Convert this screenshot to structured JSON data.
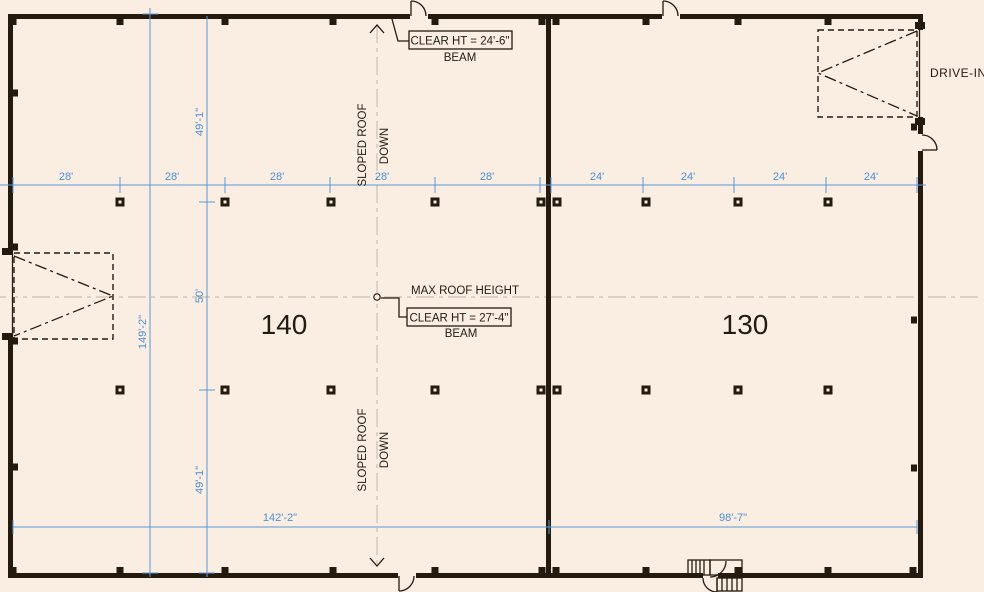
{
  "drawing": {
    "background": "#faeee3",
    "rooms": {
      "left": "140",
      "right": "130"
    },
    "labels": {
      "drive_in": "DRIVE-IN",
      "max_roof_height": "MAX ROOF HEIGHT",
      "top_clear_ht": "CLEAR HT = 24'-6\"",
      "top_beam": "BEAM",
      "center_clear_ht": "CLEAR HT = 27'-4\"",
      "center_beam": "BEAM",
      "sloped_roof": "SLOPED ROOF",
      "down": "DOWN"
    },
    "dimensions": {
      "top_left_bays": [
        "28'",
        "28'",
        "28'",
        "28'",
        "28'"
      ],
      "top_right_bays": [
        "24'",
        "24'",
        "24'",
        "24'"
      ],
      "left_total": "149'-2\"",
      "left_segments": [
        "49'-1\"",
        "50'",
        "49'-1\""
      ],
      "bottom_left": "142'-2\"",
      "bottom_right": "98'-7\""
    },
    "colors": {
      "dimension_blue": "#5b97d5",
      "dimension_text_blue": "#4c8ed2",
      "wall_black": "#241a0e",
      "centerline_gray": "#c9c0b2"
    }
  }
}
